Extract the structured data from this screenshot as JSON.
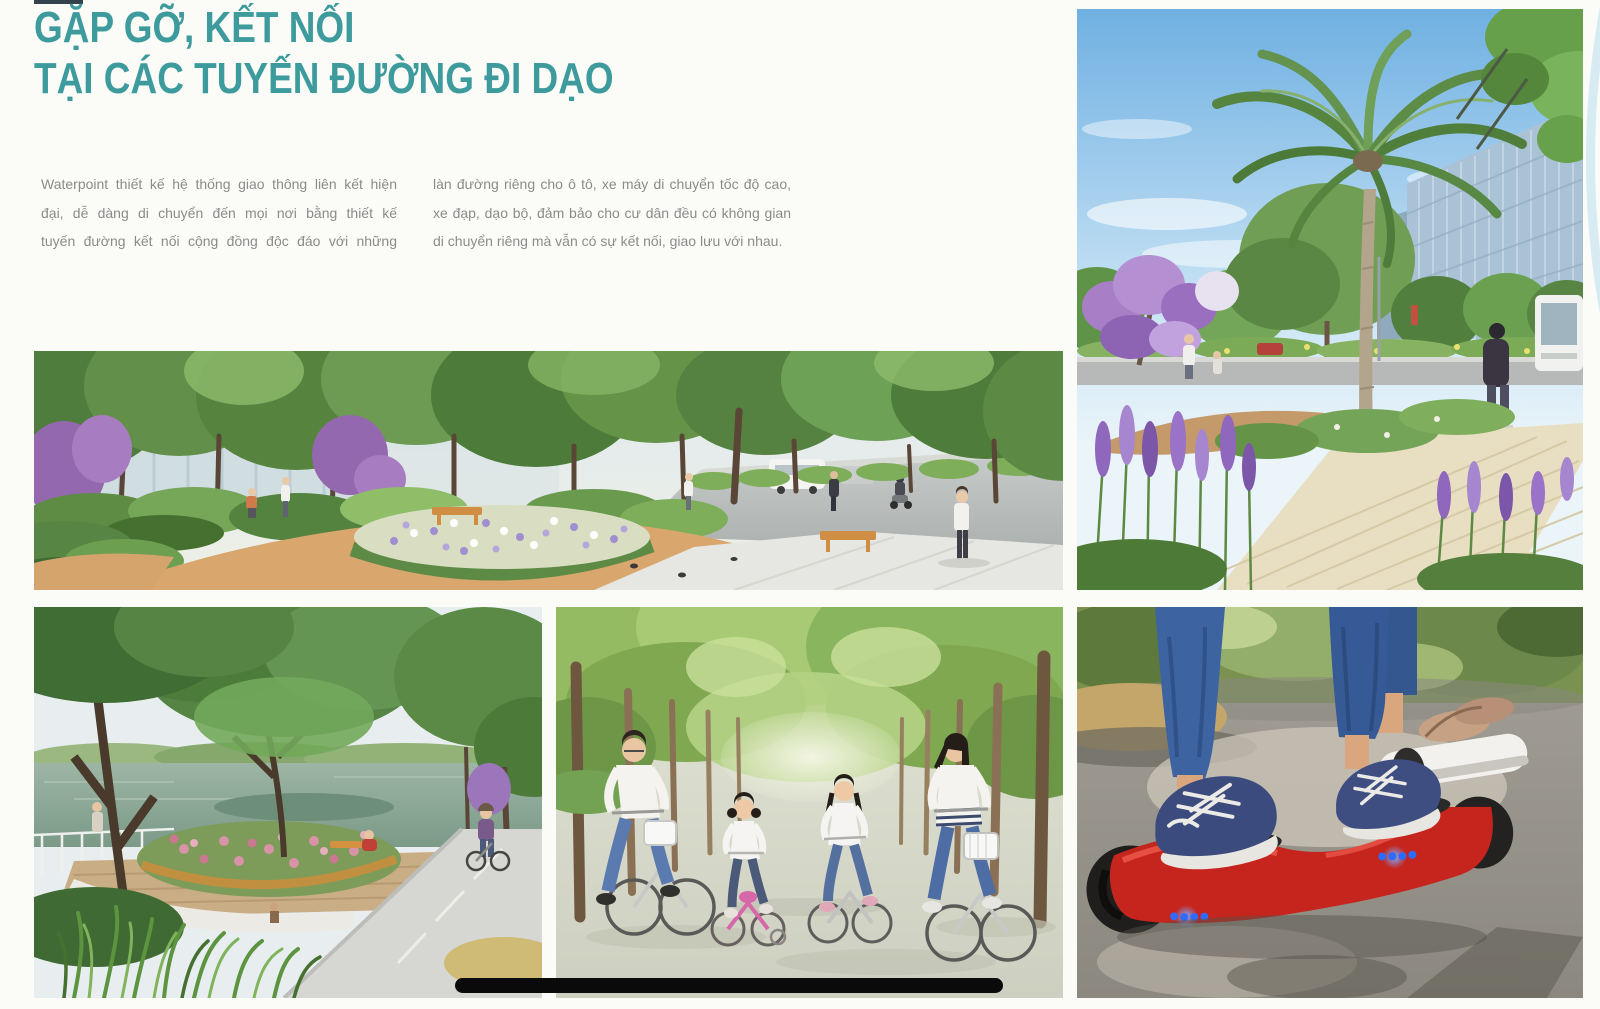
{
  "title": {
    "line1": "GẶP GỠ, KẾT NỐI",
    "line2": "TẠI CÁC TUYẾN ĐƯỜNG ĐI DẠO"
  },
  "intro": {
    "left_lines": [
      "Waterpoint thiết kế hệ thống giao thông liên kết hiện",
      "đại, dễ dàng di chuyển đến mọi nơi bằng thiết kế",
      "tuyến đường kết nối cộng đồng độc đáo với những"
    ],
    "right_lines": [
      "làn đường riêng cho ô tô, xe máy di chuyển tốc độ cao,",
      "xe đạp, dạo bộ, đảm bảo cho cư dân đều có không gian",
      "di chuyển riêng mà vẫn có sự kết nối, giao lưu với nhau."
    ]
  },
  "gallery": {
    "boulevard": {
      "label": "Phối cảnh đại lộ cây xanh với vườn hoa, ghế nghỉ và đường dạo bộ"
    },
    "palm": {
      "label": "Đường dạo với cây cọ cao, hoa oải hương và tòa nhà kính phía xa"
    },
    "lake": {
      "label": "Công viên ven hồ với bồn hoa tròn và đường đạp xe"
    },
    "cycling": {
      "label": "Gia đình bốn người đạp xe dưới hàng cây"
    },
    "hoverboard": {
      "label": "Cận cảnh đôi chân trên xe điện cân bằng màu đỏ"
    }
  },
  "colors": {
    "accent_teal": "#3e9b9d",
    "body_text": "#8b8b8b",
    "page_background": "#fbfbf8",
    "indicator_bar": "#0a0a0a"
  }
}
